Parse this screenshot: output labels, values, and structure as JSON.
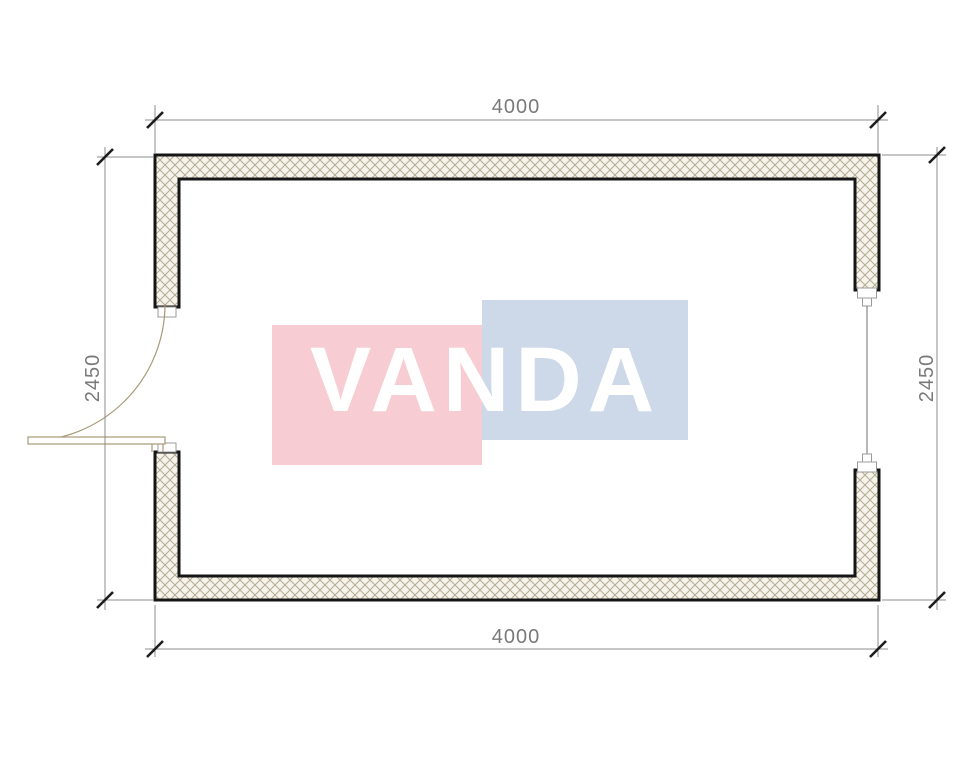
{
  "title": "container-floor-plan",
  "theme": {
    "page_bg": "#ffffff",
    "wall_fill": "#f6f3ea",
    "hatch_line": "#b3ab95",
    "wall_stroke": "#161616",
    "dim_line": "#8c8c8c",
    "tick": "#1d1d1d",
    "dim_text": "#7a7a7a",
    "door": "#a79a76",
    "cap_stroke": "#9b9b9b",
    "window_line": "#6f6f6f",
    "watermark_pink": "#f8ccd3",
    "watermark_blue": "#cdd9e9",
    "watermark_text": "#ffffff"
  },
  "dimensions": {
    "top": "4000",
    "bottom": "4000",
    "left": "2450",
    "right": "2450"
  },
  "watermark": {
    "text": "VANDA"
  }
}
